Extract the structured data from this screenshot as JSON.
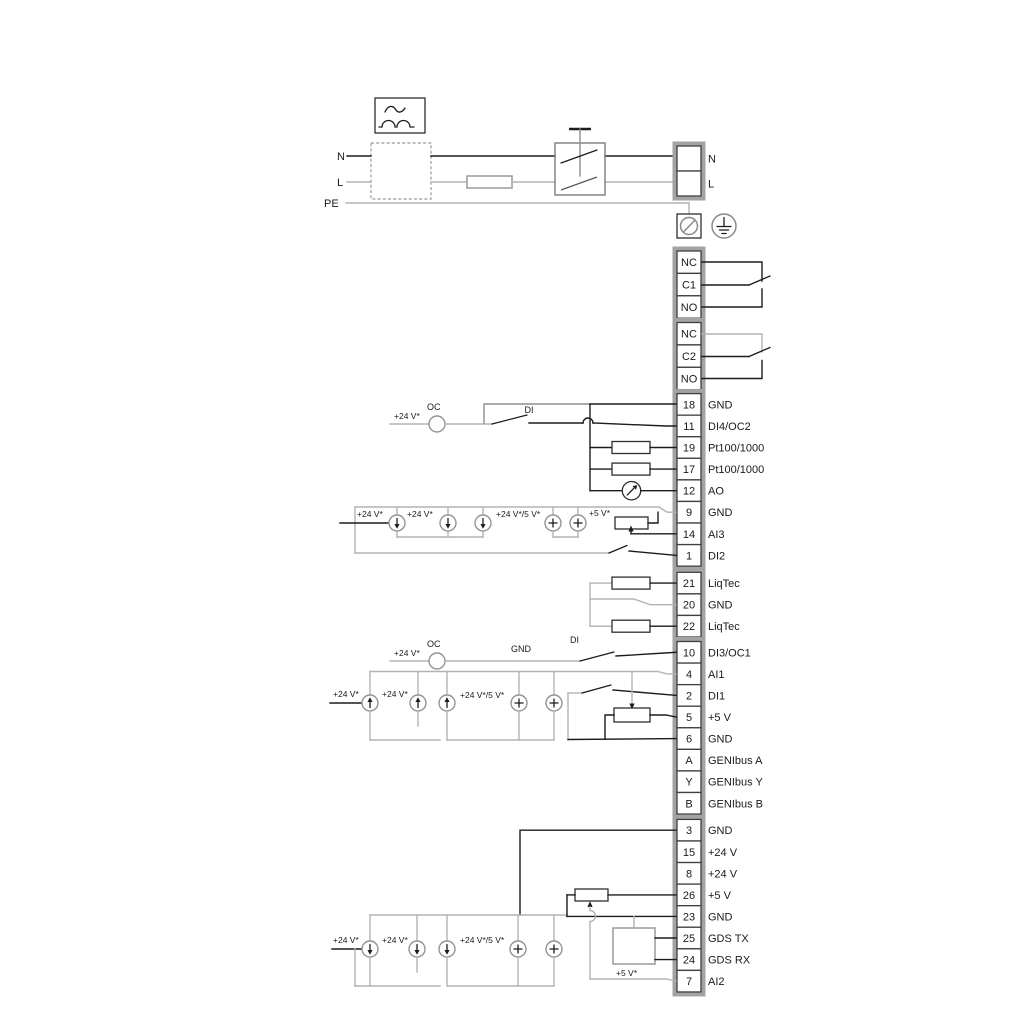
{
  "title": "Pump controller wiring diagram",
  "colors": {
    "line_dark": "#1c1c1c",
    "line_gray": "#b3b3b3",
    "strip_border": "#a3a3a3",
    "cell_fill": "#ffffff",
    "text": "#1a1a1a",
    "background": "#ffffff"
  },
  "mains": {
    "n": "N",
    "l": "L",
    "pe": "PE"
  },
  "mains_block": [
    {
      "no": "",
      "label": "N"
    },
    {
      "no": "",
      "label": "L"
    }
  ],
  "relay1": [
    {
      "no": "NC"
    },
    {
      "no": "C1"
    },
    {
      "no": "NO"
    }
  ],
  "relay2": [
    {
      "no": "NC"
    },
    {
      "no": "C2"
    },
    {
      "no": "NO"
    }
  ],
  "strip_a": [
    {
      "no": "18",
      "label": "GND"
    },
    {
      "no": "11",
      "label": "DI4/OC2"
    },
    {
      "no": "19",
      "label": "Pt100/1000"
    },
    {
      "no": "17",
      "label": "Pt100/1000"
    },
    {
      "no": "12",
      "label": "AO"
    },
    {
      "no": "9",
      "label": "GND"
    },
    {
      "no": "14",
      "label": "AI3"
    },
    {
      "no": "1",
      "label": "DI2"
    }
  ],
  "strip_liqtec": [
    {
      "no": "21",
      "label": "LiqTec"
    },
    {
      "no": "20",
      "label": "GND"
    },
    {
      "no": "22",
      "label": "LiqTec"
    }
  ],
  "strip_b": [
    {
      "no": "10",
      "label": "DI3/OC1"
    },
    {
      "no": "4",
      "label": "AI1"
    },
    {
      "no": "2",
      "label": "DI1"
    },
    {
      "no": "5",
      "label": "+5 V"
    },
    {
      "no": "6",
      "label": "GND"
    },
    {
      "no": "A",
      "label": "GENIbus A"
    },
    {
      "no": "Y",
      "label": "GENIbus Y"
    },
    {
      "no": "B",
      "label": "GENIbus B"
    }
  ],
  "strip_c": [
    {
      "no": "3",
      "label": "GND"
    },
    {
      "no": "15",
      "label": "+24 V"
    },
    {
      "no": "8",
      "label": "+24 V"
    },
    {
      "no": "26",
      "label": "+5 V"
    },
    {
      "no": "23",
      "label": "GND"
    },
    {
      "no": "25",
      "label": "GDS TX"
    },
    {
      "no": "24",
      "label": "GDS RX"
    },
    {
      "no": "7",
      "label": "AI2"
    }
  ],
  "sec1": {
    "supply": "+24 V*",
    "oc": "OC",
    "di": "DI",
    "v1": "+24 V*",
    "v2": "+24 V*",
    "v3": "+24 V*/5 V*",
    "v4": "+5 V*"
  },
  "sec2": {
    "supply": "+24 V*",
    "oc": "OC",
    "gnd": "GND",
    "di": "DI",
    "v1": "+24 V*",
    "v2": "+24 V*",
    "v3": "+24 V*/5 V*"
  },
  "sec3": {
    "v1": "+24 V*",
    "v2": "+24 V*",
    "v3": "+24 V*/5 V*",
    "v5": "+5 V*"
  }
}
